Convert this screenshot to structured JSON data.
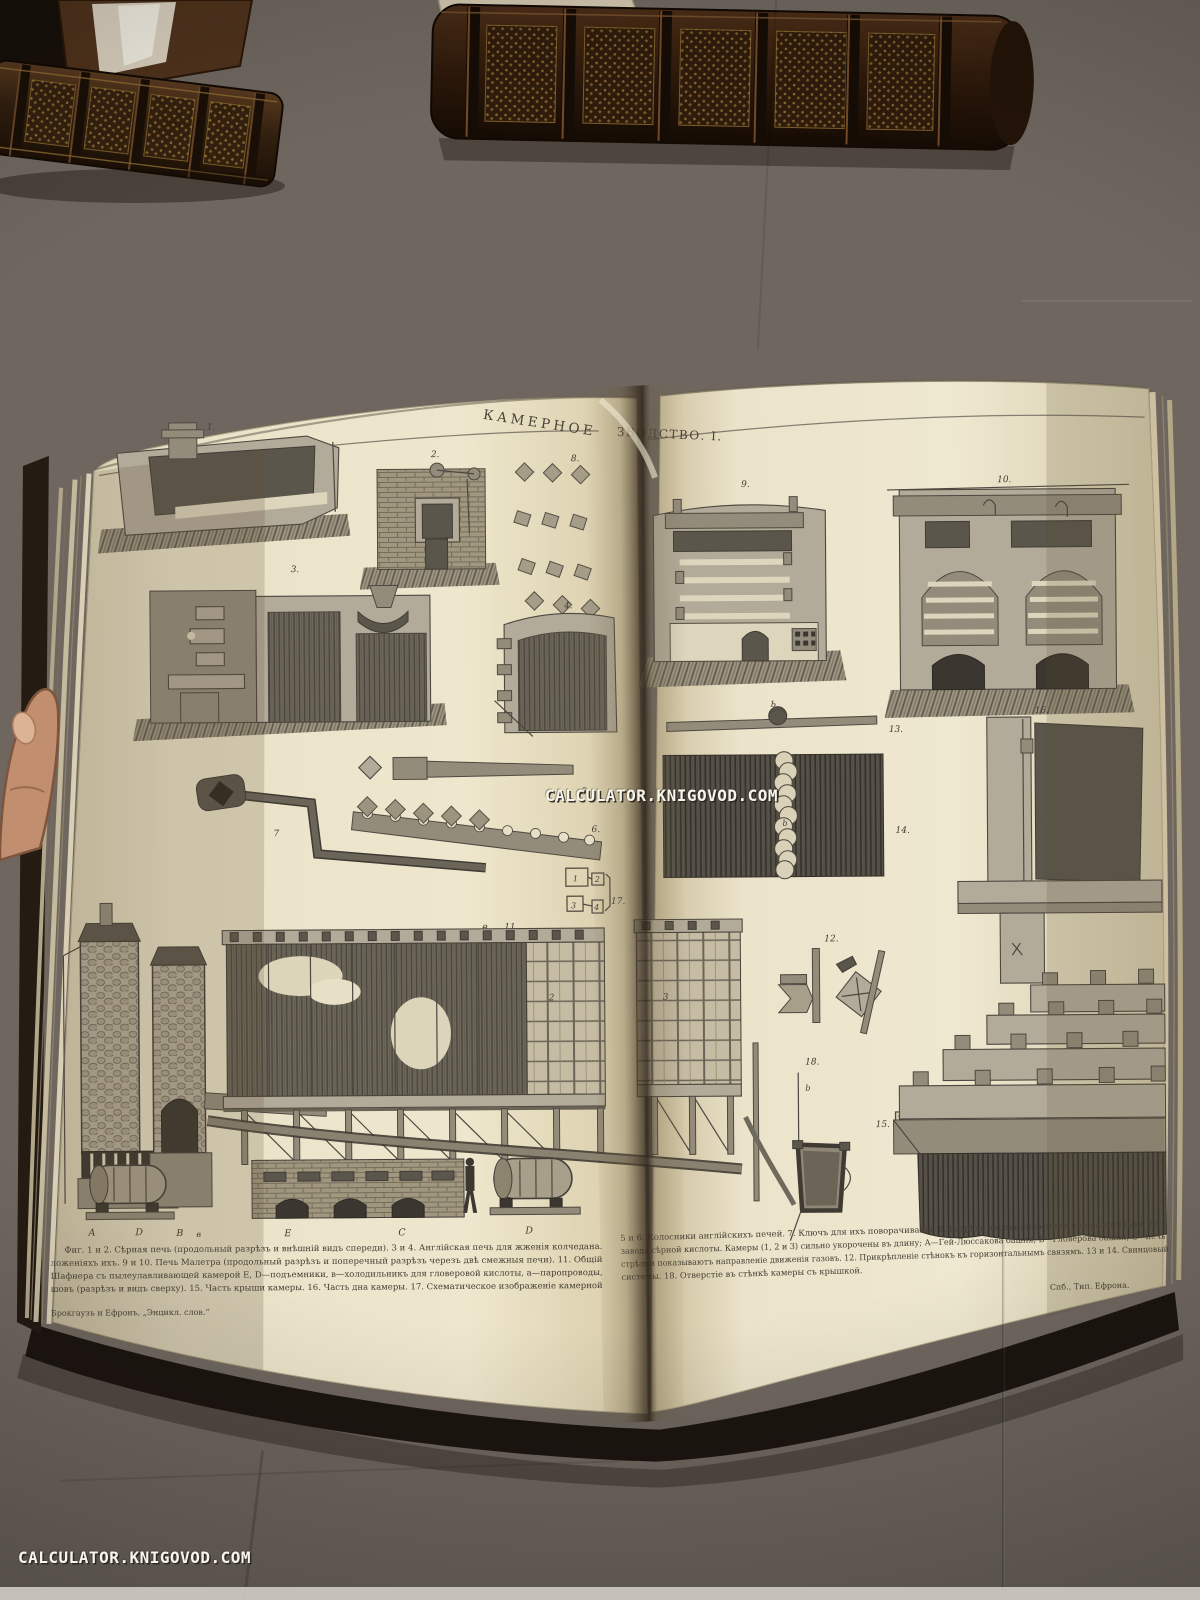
{
  "watermarks": {
    "center": "CALCULATOR.KNIGOVOD.COM",
    "bottom_left": "CALCULATOR.KNIGOVOD.COM"
  },
  "plate": {
    "title_full": "КАМЕРНОЕ ПРОИЗВОДСТВО. I.",
    "title_left": "КАМЕРНОЕ",
    "title_right": "ЗВОДСТВО. I.",
    "caption_left_lines": [
      "Фиг. 1 и 2. Сѣрная печь (продольный разрѣзъ и внѣшній видъ спереди). 3 и 4. Англійская печь для жженія колчедана.",
      "ложеніяхъ ихъ. 9 и 10. Печь Малетра (продольный разрѣзъ и поперечный разрѣзъ черезъ двѣ смежныя печи). 11. Общій",
      "Шафнера съ пылеулавливающей камерой Е, D—подъемники, в—холодильникъ для гловеровой кислоты, а—паропроводы,",
      "шовъ (разрѣзъ и видъ сверху). 15. Часть крыши камеры. 16. Часть дна камеры. 17. Схематическое изображеніе камерной"
    ],
    "caption_right_lines": [
      "5 и 6. Колосники англійскихъ печей. 7. Ключъ для ихъ поворачиванія. 8. Разрѣзъ черезъ колосники при различныхъ по-",
      "завода сѣрной кислоты. Камеры (1, 2 и 3) сильно укорочены въ длину; А—Гей-Люссакова башня, В—Гловерова башня, С—печь",
      "стрѣлки показываютъ направленіе движенія газовъ. 12. Прикрѣпленіе стѣнокъ къ горизонтальнымъ связямъ. 13 и 14. Свинцовый",
      "системы. 18. Отверстіе въ стѣнкѣ камеры съ крышкой."
    ],
    "imprint_publisher": "Брокгаузъ и Ефронъ, „Энцикл. слов.“",
    "imprint_printer": "Спб., Тип. Ефрона.",
    "labels": {
      "fig1": "1.",
      "fig2": "2.",
      "fig3": "3.",
      "fig4": "4.",
      "fig5": "5.",
      "fig6": "6.",
      "fig7": "7",
      "fig8": "8.",
      "fig9": "9.",
      "fig10": "10.",
      "fig11": "11.",
      "fig11_v": "в",
      "fig12": "12.",
      "fig13": "13.",
      "fig13_b": "Ь",
      "fig14": "14.",
      "fig14_b": "b",
      "fig15": "15.",
      "fig15_a": "a",
      "fig16": "16.",
      "fig17": "17.",
      "fig18": "18.",
      "fig18_b": "b",
      "box1": "1",
      "box2": "2",
      "box3": "3",
      "box4": "4",
      "chamber2": "2",
      "chamber3": "3"
    },
    "base_letters": [
      "А",
      "D",
      "В",
      "в",
      "Е",
      "С",
      "D"
    ]
  }
}
